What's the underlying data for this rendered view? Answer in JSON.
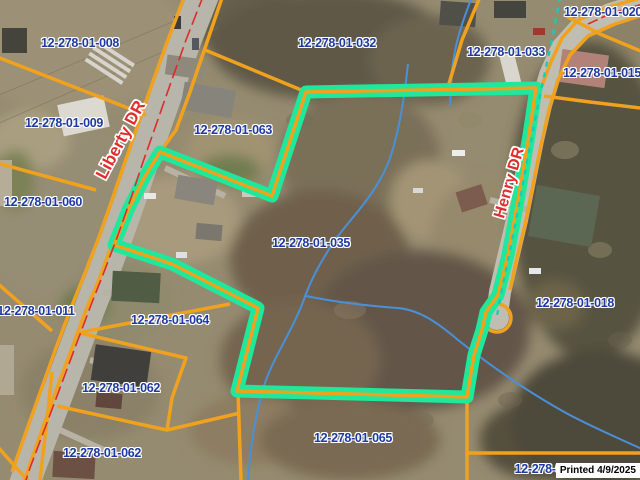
{
  "map": {
    "selected_parcel_id": "12-278-01-035",
    "printed_stamp": "Printed 4/9/2025",
    "roads": {
      "liberty": "Liberty DR",
      "henry": "Henry DR"
    },
    "parcels": [
      {
        "label": "12-278-01-008"
      },
      {
        "label": "12-278-01-032"
      },
      {
        "label": "12-278-01-020"
      },
      {
        "label": "12-278-01-033"
      },
      {
        "label": "12-278-01-015"
      },
      {
        "label": "12-278-01-009"
      },
      {
        "label": "12-278-01-063"
      },
      {
        "label": "12-278-01-060"
      },
      {
        "label": "12-278-01-035"
      },
      {
        "label": "12-278-01-018"
      },
      {
        "label": "12-278-01-011"
      },
      {
        "label": "12-278-01-064"
      },
      {
        "label": "12-278-01-062"
      },
      {
        "label": "12-278-01-065"
      },
      {
        "label": "12-278-01-062"
      },
      {
        "label": "12-278-01-0"
      }
    ],
    "legend_colors": {
      "parcel_line": "#F0A21F",
      "selection_highlight": "#1FE79B",
      "parcel_label_text": "#1E3A9E",
      "road_label_text": "#E12D2D",
      "stream_line": "#4A90D8",
      "utility_dashed_line": "#16CDB4",
      "road_centerline": "#DD2B2B"
    }
  }
}
